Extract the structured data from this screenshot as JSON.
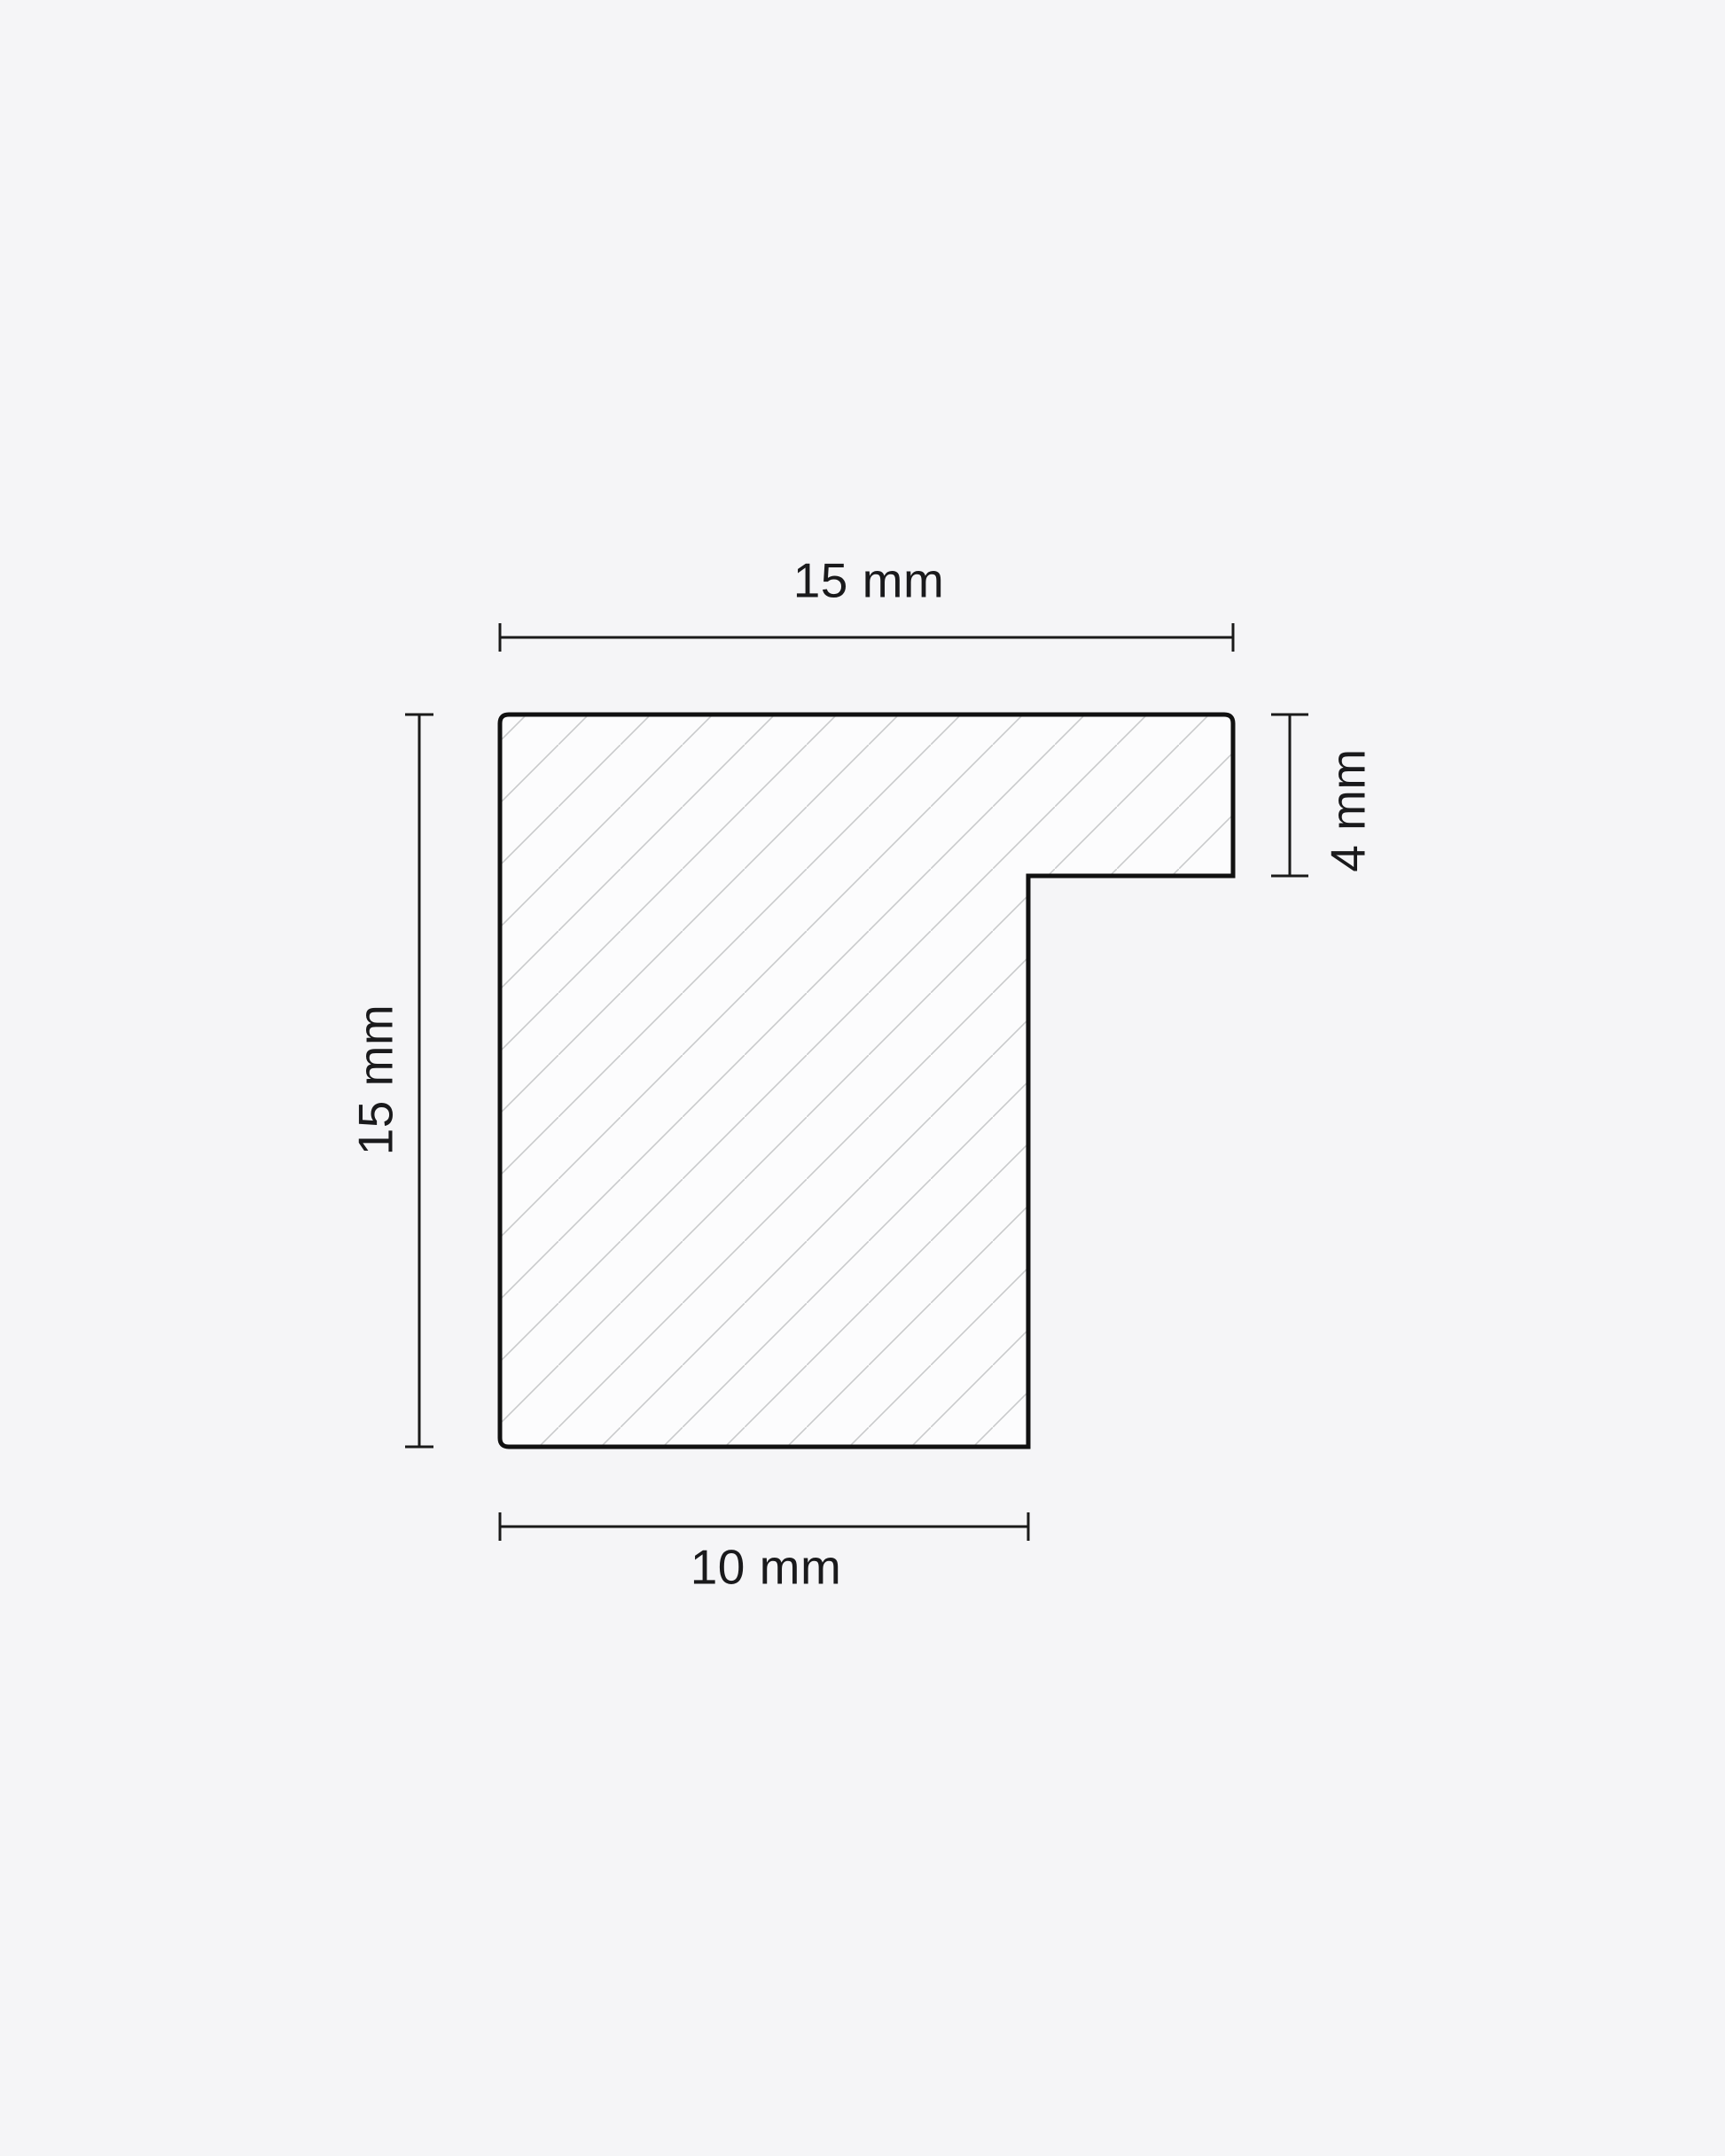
{
  "diagram": {
    "description": "Cross-section profile drawing of a picture frame moulding with diagonal hatching and dimension callouts",
    "colors": {
      "background": "#f5f5f7",
      "outline": "#111111",
      "shape_fill": "#fcfcfd",
      "hatch_lines": "#c9cacc",
      "dimension_lines": "#1a1a1a",
      "text": "#1a1a1c"
    },
    "dimensions": {
      "top": {
        "label": "15 mm"
      },
      "left": {
        "label": "15 mm"
      },
      "right": {
        "label": "4 mm"
      },
      "bottom": {
        "label": "10 mm"
      }
    }
  }
}
